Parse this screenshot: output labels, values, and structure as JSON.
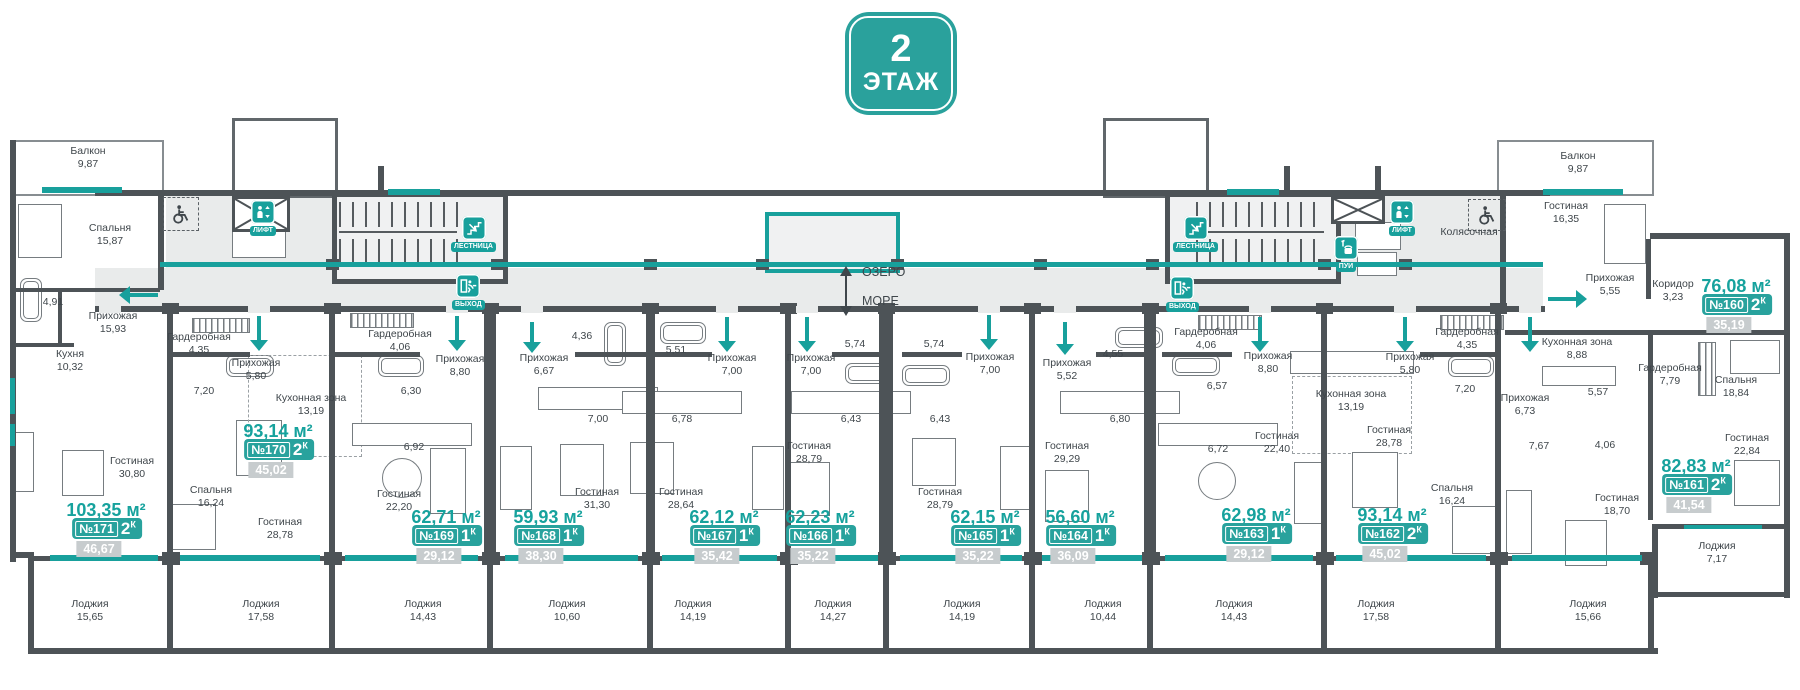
{
  "floor_badge": {
    "number": "2",
    "label": "ЭТАЖ"
  },
  "compass": {
    "up": "ОЗЕРО",
    "down": "МОРЕ"
  },
  "icons": {
    "lift": "ЛИФТ",
    "stairs": "ЛЕСТНИЦА",
    "exit": "ВЫХОД",
    "utility": "ПУИ"
  },
  "common": {
    "stroller_room": "Колясочная"
  },
  "apartments": [
    {
      "number": "№171",
      "rooms_count": "2",
      "rooms_suffix": "К",
      "total_area": "103,35 м²",
      "living_area": "46,67",
      "rooms": [
        {
          "name": "Балкон",
          "area": "9,87"
        },
        {
          "name": "Спальня",
          "area": "15,87"
        },
        {
          "name": "",
          "area": "4,91"
        },
        {
          "name": "Прихожая",
          "area": "15,93"
        },
        {
          "name": "Кухня",
          "area": "10,32"
        },
        {
          "name": "Гостиная",
          "area": "30,80"
        },
        {
          "name": "Лоджия",
          "area": "15,65"
        }
      ]
    },
    {
      "number": "№170",
      "rooms_count": "2",
      "rooms_suffix": "К",
      "total_area": "93,14 м²",
      "living_area": "45,02",
      "rooms": [
        {
          "name": "Гардеробная",
          "area": "4,35"
        },
        {
          "name": "Прихожая",
          "area": "5,80"
        },
        {
          "name": "",
          "area": "7,20"
        },
        {
          "name": "Кухонная зона",
          "area": "13,19"
        },
        {
          "name": "Спальня",
          "area": "16,24"
        },
        {
          "name": "Гостиная",
          "area": "28,78"
        },
        {
          "name": "Лоджия",
          "area": "17,58"
        }
      ]
    },
    {
      "number": "№169",
      "rooms_count": "1",
      "rooms_suffix": "К",
      "total_area": "62,71 м²",
      "living_area": "29,12",
      "rooms": [
        {
          "name": "Гардеробная",
          "area": "4,06"
        },
        {
          "name": "Прихожая",
          "area": "8,80"
        },
        {
          "name": "",
          "area": "6,30"
        },
        {
          "name": "",
          "area": "6,92"
        },
        {
          "name": "Гостиная",
          "area": "22,20"
        },
        {
          "name": "Лоджия",
          "area": "14,43"
        }
      ]
    },
    {
      "number": "№168",
      "rooms_count": "1",
      "rooms_suffix": "К",
      "total_area": "59,93 м²",
      "living_area": "38,30",
      "rooms": [
        {
          "name": "Прихожая",
          "area": "6,67"
        },
        {
          "name": "",
          "area": "4,36"
        },
        {
          "name": "",
          "area": "7,00"
        },
        {
          "name": "Гостиная",
          "area": "31,30"
        },
        {
          "name": "Лоджия",
          "area": "10,60"
        }
      ]
    },
    {
      "number": "№167",
      "rooms_count": "1",
      "rooms_suffix": "К",
      "total_area": "62,12 м²",
      "living_area": "35,42",
      "rooms": [
        {
          "name": "",
          "area": "5,51"
        },
        {
          "name": "Прихожая",
          "area": "7,00"
        },
        {
          "name": "",
          "area": "6,78"
        },
        {
          "name": "Гостиная",
          "area": "28,64"
        },
        {
          "name": "Лоджия",
          "area": "14,19"
        }
      ]
    },
    {
      "number": "№166",
      "rooms_count": "1",
      "rooms_suffix": "К",
      "total_area": "62,23 м²",
      "living_area": "35,22",
      "rooms": [
        {
          "name": "",
          "area": "5,74"
        },
        {
          "name": "Прихожая",
          "area": "7,00"
        },
        {
          "name": "",
          "area": "6,43"
        },
        {
          "name": "Гостиная",
          "area": "28,79"
        },
        {
          "name": "Лоджия",
          "area": "14,27"
        }
      ]
    },
    {
      "number": "№165",
      "rooms_count": "1",
      "rooms_suffix": "К",
      "total_area": "62,15 м²",
      "living_area": "35,22",
      "rooms": [
        {
          "name": "",
          "area": "5,74"
        },
        {
          "name": "Прихожая",
          "area": "7,00"
        },
        {
          "name": "",
          "area": "6,43"
        },
        {
          "name": "Гостиная",
          "area": "28,79"
        },
        {
          "name": "Лоджия",
          "area": "14,19"
        }
      ]
    },
    {
      "number": "№164",
      "rooms_count": "1",
      "rooms_suffix": "К",
      "total_area": "56,60 м²",
      "living_area": "36,09",
      "rooms": [
        {
          "name": "Прихожая",
          "area": "5,52"
        },
        {
          "name": "",
          "area": "4,55"
        },
        {
          "name": "",
          "area": "6,80"
        },
        {
          "name": "Гостиная",
          "area": "29,29"
        },
        {
          "name": "Лоджия",
          "area": "10,44"
        }
      ]
    },
    {
      "number": "№163",
      "rooms_count": "1",
      "rooms_suffix": "К",
      "total_area": "62,98 м²",
      "living_area": "29,12",
      "rooms": [
        {
          "name": "Гардеробная",
          "area": "4,06"
        },
        {
          "name": "Прихожая",
          "area": "8,80"
        },
        {
          "name": "",
          "area": "6,57"
        },
        {
          "name": "",
          "area": "6,72"
        },
        {
          "name": "Гостиная",
          "area": "22,40"
        },
        {
          "name": "Лоджия",
          "area": "14,43"
        }
      ]
    },
    {
      "number": "№162",
      "rooms_count": "2",
      "rooms_suffix": "К",
      "total_area": "93,14 м²",
      "living_area": "45,02",
      "rooms": [
        {
          "name": "Кухонная зона",
          "area": "13,19"
        },
        {
          "name": "Прихожая",
          "area": "5,80"
        },
        {
          "name": "Гардеробная",
          "area": "4,35"
        },
        {
          "name": "",
          "area": "7,20"
        },
        {
          "name": "Спальня",
          "area": "16,24"
        },
        {
          "name": "Гостиная",
          "area": "28,78"
        },
        {
          "name": "Лоджия",
          "area": "17,58"
        }
      ]
    },
    {
      "number": "№161",
      "rooms_count": "2",
      "rooms_suffix": "К",
      "total_area": "82,83 м²",
      "living_area": "41,54",
      "rooms": [
        {
          "name": "Прихожая",
          "area": "6,73"
        },
        {
          "name": "Кухонная зона",
          "area": "8,88"
        },
        {
          "name": "",
          "area": "5,57"
        },
        {
          "name": "",
          "area": "7,67"
        },
        {
          "name": "",
          "area": "4,06"
        },
        {
          "name": "Гостиная",
          "area": "18,70"
        },
        {
          "name": "Лоджия",
          "area": "15,66"
        }
      ]
    },
    {
      "number": "№160",
      "rooms_count": "2",
      "rooms_suffix": "К",
      "total_area": "76,08 м²",
      "living_area": "35,19",
      "rooms": [
        {
          "name": "Балкон",
          "area": "9,87"
        },
        {
          "name": "Гостиная",
          "area": "16,35"
        },
        {
          "name": "Прихожая",
          "area": "5,55"
        },
        {
          "name": "Коридор",
          "area": "3,23"
        },
        {
          "name": "Гардеробная",
          "area": "7,79"
        },
        {
          "name": "Спальня",
          "area": "18,84"
        },
        {
          "name": "Гостиная",
          "area": "22,84"
        },
        {
          "name": "Лоджия",
          "area": "7,17"
        }
      ]
    }
  ]
}
